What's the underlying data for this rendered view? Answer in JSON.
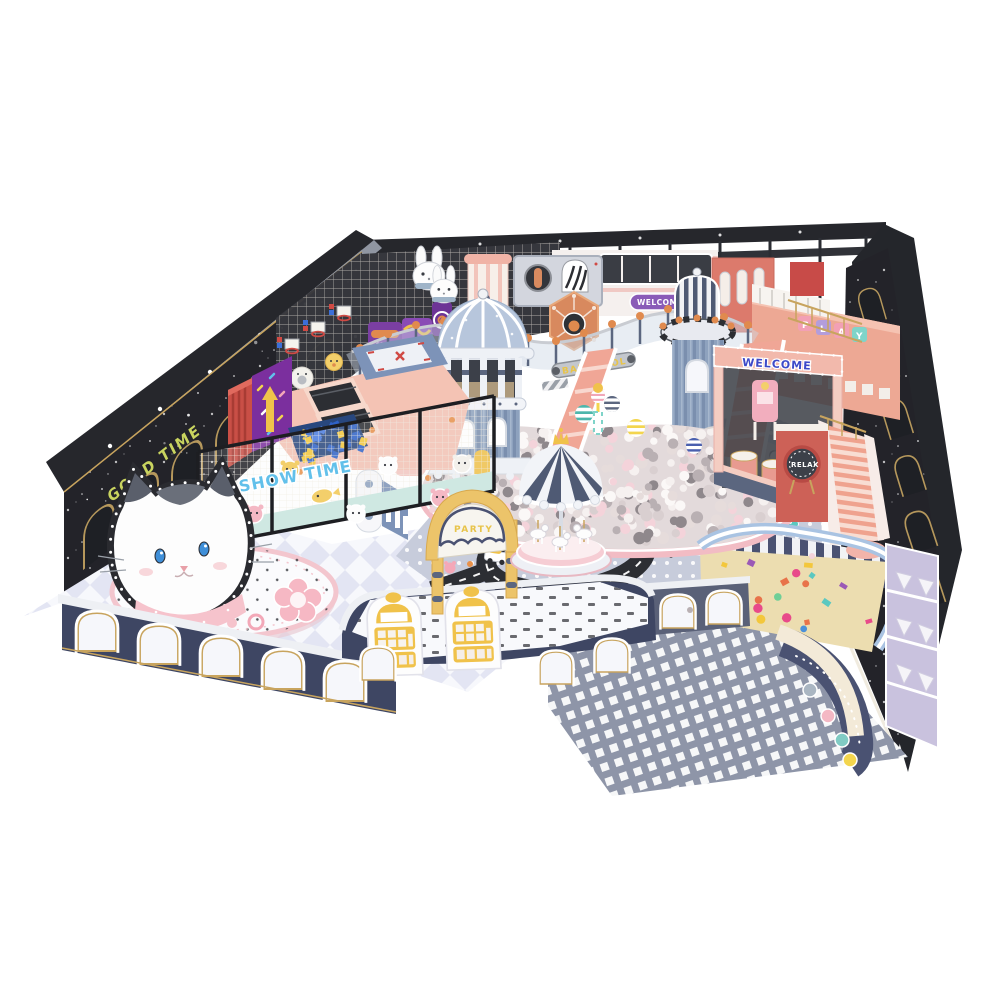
{
  "scene": {
    "title": "Indoor kids playground 3D render",
    "signs": {
      "good_time": "GOOD TIME",
      "show_time": "SHOW TIME",
      "ball_pool": "BALL POOL",
      "welcome_train": "WELCOME",
      "welcome_arch": "WELCOME",
      "relax": "RELAX",
      "party_gate": "PARTY",
      "geometry_box": "GEOMETRY",
      "play_letters": [
        "P",
        "L",
        "A",
        "Y"
      ]
    },
    "palette": {
      "wall_dark": "#232329",
      "beam_dark": "#26272c",
      "navy": "#3e4663",
      "steel_blue": "#8fa3bf",
      "dome_blue": "#b7c6dc",
      "salmon": "#ef9f8f",
      "pink_light": "#f6c3cc",
      "red_wall": "#c94f46",
      "gold_trim": "#c8a45e",
      "yellow": "#f0c24a",
      "teal": "#7fd4c9",
      "purple": "#7b2f9e",
      "floor_dot_gray": "#c6cbd9",
      "floor_check_gray": "#8e95a8",
      "sand": "#ecddb0",
      "ball_pink": "#f4d3da",
      "ball_gray": "#b9b0b3"
    }
  }
}
